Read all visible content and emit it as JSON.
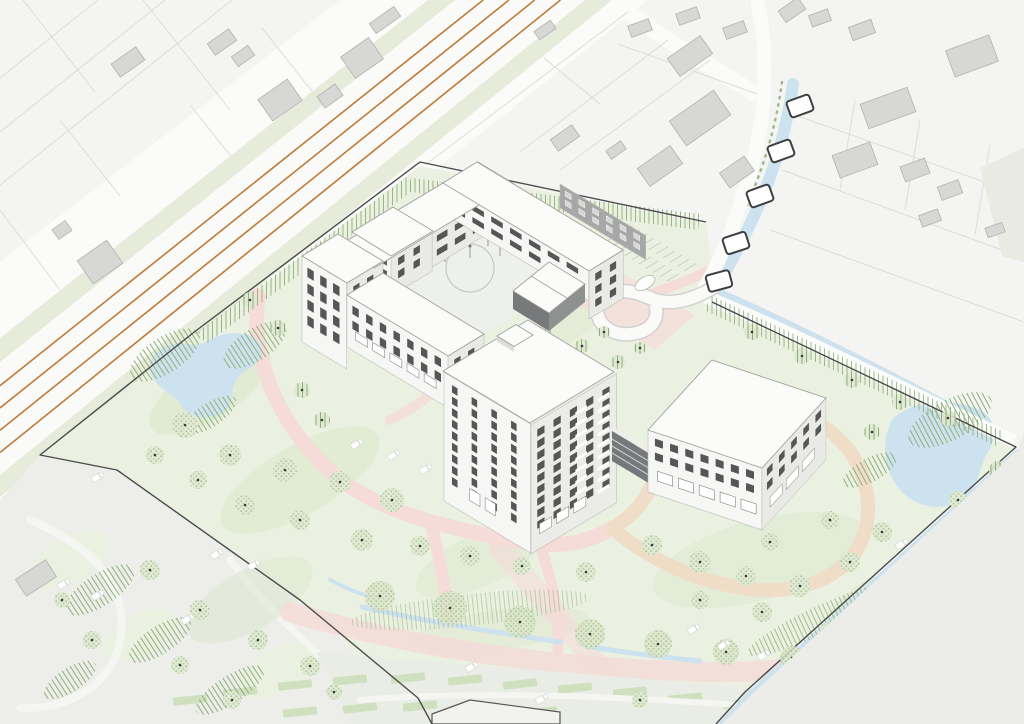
{
  "scene": {
    "title": "Axonometric architectural site plan rendering",
    "description": "Bird's-eye axonometric illustration of a care-campus development: a U-shaped courtyard building, a twelve-storey tower and a low garden pavilion set in a green park with ponds, pink walking loops, a railway corridor, a canal with bridges and surrounding housing parcels.",
    "buildings": [
      {
        "id": "courtyard-building",
        "storeys": "3-5",
        "roof": "flat white"
      },
      {
        "id": "tower",
        "storeys": "12",
        "roof": "flat white with rooftop box"
      },
      {
        "id": "garden-building",
        "storeys": "4",
        "roof": "flat white"
      },
      {
        "id": "link-bridge",
        "storeys": "glazed connector"
      }
    ],
    "railway_track_count": 4,
    "canal_bridge_count": 5,
    "pond_count": 2
  },
  "palette": {
    "bg": "#f4f4f2",
    "road": "#fbfbfa",
    "curb": "#d7d7d4",
    "parcel_line": "#dcdcd9",
    "ctx_bldg": "#d7d7d5",
    "ctx_bldg_line": "#b2b2b0",
    "rail_verge": "#e6ebda",
    "rail_bed": "#fafaf8",
    "rail_track": "#bf7b3c",
    "water": "#cde2ef",
    "plaza": "#ededea",
    "field": "#e9ebe3",
    "field2": "#ecede8",
    "terrace": "#eaece6",
    "terr_strip": "#cfe0bf",
    "lawn": "#ebf1e1",
    "lawn_dark": "#dbe7cb",
    "hatch_green": "#8fae7c",
    "path_pink": "#f5dcd8",
    "path_salmon": "#efddc8",
    "boundary": "#4b4b4b",
    "roof": "#fbfbf9",
    "roof_line": "#a0a09d",
    "facade_light": "#f6f6f4",
    "facade_mid": "#e9e9e5",
    "facade_dark": "#a6a7a6",
    "facade_tower_se": "#ebebe8",
    "window": "#565656",
    "window_frame": "#fdfdfc",
    "glass_dark": "#75797b",
    "tree_base": "#e0e9d3",
    "tree_canopy": "#d9e5c8",
    "tree_dot_ink": "#3a3a3a",
    "courtyard": "#eef0ec",
    "furniture": "#ffffff"
  },
  "railway": {
    "tracks": [
      0.3,
      0.44,
      0.58,
      0.72
    ],
    "top_x_min": 428,
    "top_x_max": 612,
    "left_y_min": 338,
    "left_y_max": 497
  },
  "bridges": [
    [
      800,
      106,
      -20
    ],
    [
      781,
      151,
      -20
    ],
    [
      760,
      196,
      -20
    ],
    [
      736,
      243,
      -18
    ],
    [
      719,
      281,
      -15
    ]
  ],
  "trees": [
    [
      185,
      425,
      13,
      0
    ],
    [
      230,
      455,
      11,
      0
    ],
    [
      285,
      470,
      12,
      0
    ],
    [
      340,
      482,
      11,
      0
    ],
    [
      392,
      500,
      12,
      0
    ],
    [
      300,
      520,
      10,
      0
    ],
    [
      245,
      505,
      10,
      0
    ],
    [
      198,
      480,
      9,
      0
    ],
    [
      362,
      540,
      11,
      0
    ],
    [
      420,
      546,
      10,
      0
    ],
    [
      155,
      455,
      9,
      0
    ],
    [
      470,
      556,
      10,
      0
    ],
    [
      522,
      566,
      9,
      0
    ],
    [
      586,
      572,
      10,
      0
    ],
    [
      250,
      300,
      8,
      1
    ],
    [
      278,
      328,
      8,
      1
    ],
    [
      302,
      390,
      8,
      1
    ],
    [
      322,
      420,
      8,
      1
    ],
    [
      545,
      332,
      7,
      1
    ],
    [
      582,
      346,
      7,
      1
    ],
    [
      618,
      362,
      7,
      1
    ],
    [
      652,
      545,
      10,
      0
    ],
    [
      700,
      562,
      11,
      0
    ],
    [
      746,
      576,
      10,
      0
    ],
    [
      800,
      586,
      11,
      0
    ],
    [
      850,
      562,
      10,
      0
    ],
    [
      882,
      532,
      10,
      0
    ],
    [
      830,
      520,
      9,
      0
    ],
    [
      770,
      542,
      9,
      0
    ],
    [
      700,
      600,
      9,
      0
    ],
    [
      762,
      612,
      10,
      0
    ],
    [
      830,
      632,
      10,
      0
    ],
    [
      900,
      622,
      9,
      0
    ],
    [
      938,
      592,
      9,
      0
    ],
    [
      752,
      332,
      8,
      1
    ],
    [
      802,
      356,
      8,
      1
    ],
    [
      852,
      380,
      8,
      1
    ],
    [
      900,
      402,
      8,
      1
    ],
    [
      948,
      418,
      8,
      1
    ],
    [
      872,
      432,
      8,
      1
    ],
    [
      998,
      470,
      9,
      1
    ],
    [
      958,
      500,
      9,
      0
    ],
    [
      150,
      570,
      10,
      0
    ],
    [
      200,
      610,
      10,
      0
    ],
    [
      258,
      640,
      10,
      0
    ],
    [
      310,
      666,
      10,
      0
    ],
    [
      180,
      665,
      9,
      0
    ],
    [
      92,
      640,
      9,
      0
    ],
    [
      62,
      600,
      8,
      0
    ],
    [
      380,
      596,
      15,
      2
    ],
    [
      450,
      608,
      17,
      2
    ],
    [
      520,
      622,
      16,
      2
    ],
    [
      590,
      634,
      15,
      2
    ],
    [
      658,
      644,
      14,
      2
    ],
    [
      726,
      652,
      13,
      2
    ],
    [
      792,
      658,
      12,
      2
    ],
    [
      880,
      636,
      12,
      2
    ],
    [
      946,
      640,
      11,
      2
    ],
    [
      232,
      700,
      9,
      0
    ],
    [
      334,
      692,
      8,
      0
    ],
    [
      640,
      700,
      8,
      0
    ],
    [
      470,
      268,
      7,
      0
    ],
    [
      604,
      332,
      6,
      1
    ],
    [
      640,
      348,
      6,
      1
    ]
  ],
  "furniture": [
    [
      355,
      445
    ],
    [
      392,
      456
    ],
    [
      424,
      470
    ],
    [
      96,
      478
    ],
    [
      62,
      585
    ],
    [
      96,
      596
    ],
    [
      215,
      555
    ],
    [
      252,
      566
    ],
    [
      692,
      630
    ],
    [
      722,
      646
    ],
    [
      762,
      656
    ],
    [
      900,
      545
    ],
    [
      932,
      560
    ],
    [
      962,
      576
    ],
    [
      470,
      668
    ],
    [
      186,
      620
    ],
    [
      540,
      700
    ],
    [
      875,
      690
    ]
  ],
  "parking": {
    "x": 602,
    "y": 244,
    "rows": 10,
    "step": 8.2,
    "banks": [
      [
        2,
        16
      ],
      [
        22,
        36
      ]
    ],
    "car": [
      645,
      283
    ]
  },
  "facades": [
    {
      "id": "courtyard-ne-strip",
      "m": "V",
      "x": 560,
      "y": 184,
      "len": 100,
      "hgt": 24,
      "fill": "facade_dark",
      "win": {
        "cols": 6,
        "rows": 2,
        "ox": 6,
        "oy": 4,
        "dx": 16,
        "dy": 9,
        "w": 7,
        "h": 5,
        "fill": "#d6d6d3"
      }
    },
    {
      "id": "north-wing-courtyard",
      "m": "U",
      "x": 374,
      "y": 268,
      "len": 160,
      "hgt": 34,
      "fill": "facade_mid",
      "win": {
        "cols": 7,
        "rows": 2,
        "ox": 10,
        "oy": 5,
        "dx": 21,
        "dy": 14,
        "w": 13,
        "h": 7
      }
    },
    {
      "id": "east-wing-courtyard",
      "m": "V",
      "x": 443,
      "y": 183,
      "len": 170,
      "hgt": 30,
      "fill": "facade_light",
      "win": {
        "cols": 7,
        "rows": 2,
        "ox": 12,
        "oy": 4,
        "dx": 22,
        "dy": 12,
        "w": 14,
        "h": 6
      }
    },
    {
      "id": "east-wing-end",
      "m": "U",
      "x": 589,
      "y": 271,
      "len": 40,
      "hgt": 48,
      "fill": "facade_mid",
      "win": {
        "cols": 2,
        "rows": 3,
        "ox": 7,
        "oy": 6,
        "dx": 17,
        "dy": 13,
        "w": 8,
        "h": 8
      }
    },
    {
      "id": "inner-block-sw",
      "m": "V",
      "x": 352,
      "y": 232,
      "len": 46,
      "hgt": 44,
      "fill": "facade_light",
      "win": {
        "cols": 3,
        "rows": 3,
        "ox": 6,
        "oy": 5,
        "dx": 14,
        "dy": 13,
        "w": 7,
        "h": 8
      }
    },
    {
      "id": "inner-block-end",
      "m": "U",
      "x": 391,
      "y": 256,
      "len": 48,
      "hgt": 40,
      "fill": "facade_mid",
      "win": {
        "cols": 2,
        "rows": 2,
        "ox": 8,
        "oy": 6,
        "dx": 18,
        "dy": 13,
        "w": 8,
        "h": 8
      }
    },
    {
      "id": "west-tall-sw",
      "m": "V",
      "x": 302,
      "y": 256,
      "len": 52,
      "hgt": 86,
      "fill": "facade_light",
      "win": {
        "cols": 3,
        "rows": 4,
        "ox": 6,
        "oy": 8,
        "dx": 15,
        "dy": 16,
        "w": 8,
        "h": 10
      }
    },
    {
      "id": "west-tall-end",
      "m": "U",
      "x": 347,
      "y": 283,
      "len": 42,
      "hgt": 62,
      "fill": "facade_mid",
      "win": {
        "cols": 2,
        "rows": 3,
        "ox": 7,
        "oy": 7,
        "dx": 16,
        "dy": 15,
        "w": 8,
        "h": 9
      }
    },
    {
      "id": "west-low-sw",
      "m": "V",
      "x": 347,
      "y": 295,
      "len": 118,
      "hgt": 52,
      "fill": "facade_light",
      "win": {
        "cols": 7,
        "rows": 2,
        "ox": 6,
        "oy": 7,
        "dx": 16,
        "dy": 15,
        "w": 8,
        "h": 9
      },
      "ground": {
        "cols": 5,
        "ox": 10,
        "w": 14,
        "h": 8,
        "yoff": 12
      }
    },
    {
      "id": "west-low-end",
      "m": "U",
      "x": 448,
      "y": 356,
      "len": 42,
      "hgt": 46,
      "fill": "facade_mid",
      "win": {
        "cols": 2,
        "rows": 2,
        "ox": 7,
        "oy": 7,
        "dx": 16,
        "dy": 14,
        "w": 8,
        "h": 8
      }
    },
    {
      "id": "tower-west",
      "m": "V",
      "x": 444,
      "y": 372,
      "len": 101,
      "hgt": 129,
      "fill": "facade_light",
      "win": {
        "cols": 4,
        "rows": 9,
        "ox": 9,
        "oy": 8,
        "dx": 23,
        "dy": 11.5,
        "w": 7,
        "h": 8
      },
      "ground": {
        "cols": 2,
        "ox": 30,
        "w": 12,
        "h": 12,
        "yoff": 16
      }
    },
    {
      "id": "tower-southeast",
      "m": "U",
      "x": 531,
      "y": 425,
      "len": 100,
      "hgt": 129,
      "fill": "facade_tower_se",
      "win": {
        "cols": 5,
        "rows": 9,
        "ox": 7,
        "oy": 8,
        "dx": 19,
        "dy": 11.5,
        "w": 9,
        "h": 8
      },
      "win2": {
        "cols": 2,
        "rows": 9,
        "ox": 52,
        "oy": 14,
        "dx": 26,
        "dy": 11.5,
        "w": 13,
        "h": 3,
        "fill": "#ffffff"
      },
      "ground": {
        "cols": 3,
        "ox": 10,
        "w": 14,
        "h": 10,
        "yoff": 15
      }
    },
    {
      "id": "garden-sw",
      "m": "A",
      "x": 648,
      "y": 430,
      "len": 120,
      "hgt": 62,
      "fill": "facade_light",
      "win": {
        "cols": 7,
        "rows": 2,
        "ox": 7,
        "oy": 6,
        "dx": 16,
        "dy": 14,
        "w": 9,
        "h": 8
      },
      "ground": {
        "cols": 5,
        "ox": 10,
        "w": 16,
        "h": 10,
        "yoff": 14
      }
    },
    {
      "id": "garden-se",
      "m": "B",
      "x": 762,
      "y": 468,
      "len": 95,
      "hgt": 62,
      "fill": "facade_mid",
      "win": {
        "cols": 5,
        "rows": 2,
        "ox": 7,
        "oy": 6,
        "dx": 18,
        "dy": 14,
        "w": 9,
        "h": 8
      },
      "ground": {
        "cols": 3,
        "ox": 12,
        "w": 18,
        "h": 10,
        "yoff": 14
      }
    }
  ],
  "context_buildings": {
    "top_left_rot": -35,
    "top_left": [
      [
        128,
        62,
        30,
        16
      ],
      [
        222,
        42,
        26,
        14
      ],
      [
        243,
        56,
        20,
        12
      ],
      [
        280,
        100,
        36,
        26
      ],
      [
        330,
        96,
        22,
        14
      ],
      [
        362,
        58,
        34,
        26
      ],
      [
        385,
        20,
        30,
        12
      ],
      [
        100,
        262,
        36,
        28
      ],
      [
        62,
        230,
        16,
        12
      ]
    ],
    "top_center_rot": -35,
    "top_center": [
      [
        545,
        30,
        20,
        10
      ],
      [
        565,
        138,
        26,
        14
      ],
      [
        616,
        150,
        18,
        10
      ],
      [
        660,
        166,
        40,
        22
      ],
      [
        700,
        118,
        54,
        30
      ],
      [
        737,
        172,
        30,
        18
      ],
      [
        690,
        56,
        40,
        22
      ],
      [
        792,
        10,
        24,
        14
      ]
    ],
    "top_right_rot": -20,
    "top_right": [
      [
        640,
        28,
        22,
        12
      ],
      [
        688,
        16,
        22,
        12
      ],
      [
        735,
        30,
        22,
        12
      ],
      [
        820,
        18,
        20,
        12
      ],
      [
        862,
        30,
        24,
        14
      ],
      [
        972,
        56,
        46,
        28
      ],
      [
        888,
        108,
        50,
        26
      ],
      [
        855,
        160,
        40,
        24
      ],
      [
        915,
        170,
        26,
        16
      ],
      [
        950,
        190,
        22,
        14
      ],
      [
        930,
        218,
        20,
        12
      ],
      [
        995,
        230,
        18,
        10
      ]
    ],
    "shed": [
      36,
      578,
      36,
      20
    ]
  }
}
